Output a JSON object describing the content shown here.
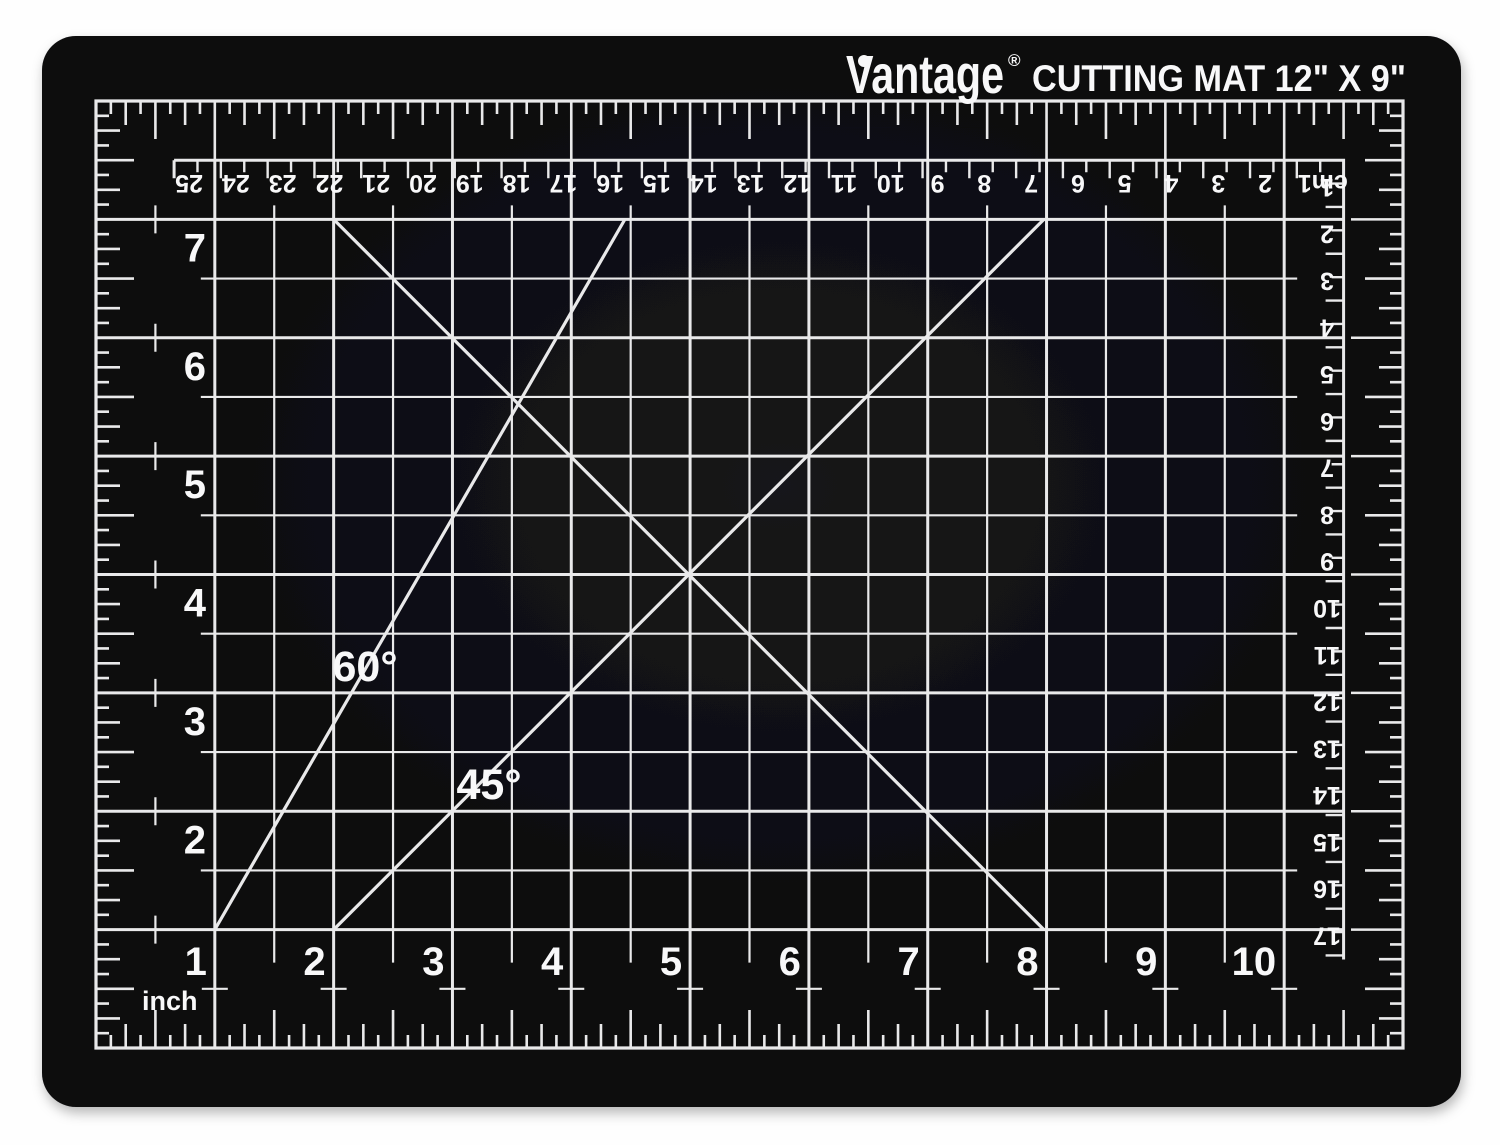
{
  "product": {
    "brand": "Vantage",
    "registered": "®",
    "title": "CUTTING MAT 12\" X 9\""
  },
  "colors": {
    "background": "#fefefe",
    "mat": "#0b0b0d",
    "mat_highlight": "#17171b",
    "lines": "#e9e9ea",
    "text": "#f8f8f9"
  },
  "rulers": {
    "top_cm": {
      "unit": "cm",
      "labels": [
        "cm1",
        "2",
        "3",
        "4",
        "5",
        "6",
        "7",
        "8",
        "9",
        "10",
        "11",
        "12",
        "13",
        "14",
        "15",
        "16",
        "17",
        "18",
        "19",
        "20",
        "21",
        "22",
        "23",
        "24",
        "25"
      ]
    },
    "right_cm": {
      "labels": [
        "1",
        "2",
        "3",
        "4",
        "5",
        "6",
        "7",
        "8",
        "9",
        "10",
        "11",
        "12",
        "13",
        "14",
        "15",
        "16",
        "17"
      ]
    },
    "left_inch": {
      "labels": [
        "7",
        "6",
        "5",
        "4",
        "3",
        "2"
      ]
    },
    "bottom_inch": {
      "labels": [
        "1",
        "2",
        "3",
        "4",
        "5",
        "6",
        "7",
        "8",
        "9",
        "10"
      ],
      "unit_label": "inch"
    }
  },
  "angles": {
    "sixty": "60°",
    "forty_five": "45°"
  }
}
